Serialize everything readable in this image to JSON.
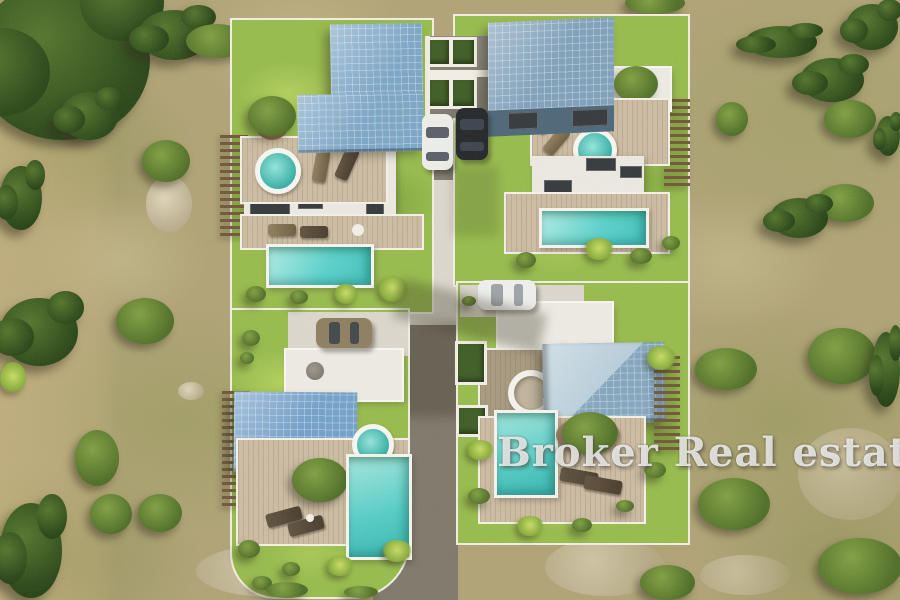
{
  "watermark": {
    "text": "Broker Real estate"
  },
  "scene": {
    "setting": "aerial-render-of-villa-development",
    "terrain": [
      "dry-scrubland",
      "olive-trees",
      "shrubs",
      "rock-outcrops",
      "dirt-track"
    ],
    "villas": [
      {
        "position": "top-left",
        "roof": "blue-tiled-L-shape",
        "amenities": [
          "rooftop-terrace",
          "hot-tub",
          "sun-loungers",
          "potted-tree",
          "swimming-pool",
          "lawn",
          "pergola"
        ]
      },
      {
        "position": "top-right",
        "roof": "blue-tiled",
        "amenities": [
          "rooftop-terrace",
          "hot-tub",
          "sun-loungers",
          "potted-tree",
          "swimming-pool",
          "lawn",
          "pergola",
          "driveway"
        ]
      },
      {
        "position": "bottom-left",
        "roof": "blue-tiled",
        "amenities": [
          "white-terrace",
          "fire-pit",
          "hot-tub",
          "tree-planter",
          "swimming-pool",
          "sun-loungers",
          "lawn",
          "pergola",
          "driveway"
        ]
      },
      {
        "position": "bottom-right",
        "roof": "blue-tiled-diagonal-shading",
        "amenities": [
          "white-terrace",
          "round-skylight",
          "tree-planter",
          "swimming-pool",
          "sun-loungers",
          "lawn",
          "pergola",
          "hedges",
          "driveway"
        ]
      }
    ],
    "vehicles": [
      {
        "color": "white",
        "location": "central-driveway"
      },
      {
        "color": "black",
        "location": "central-driveway"
      },
      {
        "color": "bronze",
        "location": "bottom-left-villa-driveway"
      },
      {
        "color": "white",
        "location": "bottom-right-villa-driveway"
      }
    ],
    "road": "central-access-road"
  },
  "palette": {
    "scrub": "#ab9f74",
    "dirt": "#c7b280",
    "lawn": "#93b84c",
    "roof_blue": "#78a2c4",
    "roof_blue_light": "#b5cbd8",
    "roof_front": "#4a6478",
    "pool": "#58cfc9",
    "deck": "#c8b8a0",
    "terrace": "#ebe8e1",
    "road": "#7b756a",
    "plaza": "#d9d4ca",
    "tree_dark": "#2a461b",
    "bush_green": "#7d9c43",
    "car_white": "#eaeae7",
    "car_black": "#23262b",
    "car_bronze": "#8a7b60",
    "pergola_wood": "#6e543a",
    "watermark_white": "#ffffff"
  }
}
